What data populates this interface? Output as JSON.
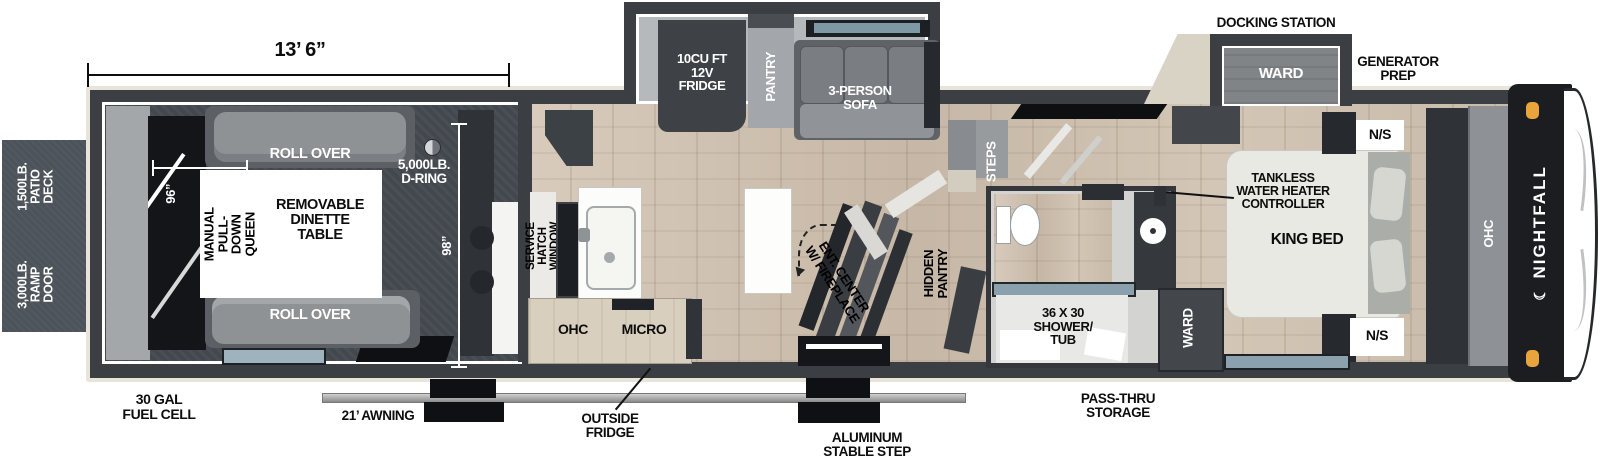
{
  "brand": {
    "name": "NIGHTFALL",
    "moon": "☾"
  },
  "dims": {
    "length": "13’ 6”",
    "garage_width": "96”",
    "garage_depth": "98”"
  },
  "exterior": {
    "patio_deck": "1,500LB.\nPATIO DECK",
    "ramp_door": "3,000LB.\nRAMP DOOR",
    "fuel_cell": "30 GAL\nFUEL CELL",
    "awning": "21’ AWNING",
    "outside_fridge": "OUTSIDE\nFRIDGE",
    "stable_step": "ALUMINUM\nSTABLE STEP",
    "pass_thru": "PASS-THRU\nSTORAGE",
    "docking_station": "DOCKING STATION",
    "generator_prep": "GENERATOR\nPREP"
  },
  "garage": {
    "roll_over": "ROLL OVER",
    "queen": "MANUAL\nPULL-DOWN\nQUEEN",
    "dinette": "REMOVABLE\nDINETTE\nTABLE",
    "d_ring": "5,000LB.\nD-RING"
  },
  "kitchen": {
    "service_hatch": "SERVICE HATCH\nWINDOW",
    "ohc": "OHC",
    "micro": "MICRO",
    "fridge": "10CU FT\n12V\nFRIDGE",
    "pantry": "PANTRY",
    "sofa": "3-PERSON\nSOFA",
    "ent_center": "ENT. CENTER\nW/ FIREPLACE",
    "hidden_pantry": "HIDDEN\nPANTRY",
    "steps": "STEPS"
  },
  "bath": {
    "shower": "36 X 30\nSHOWER/\nTUB",
    "ward": "WARD"
  },
  "bedroom": {
    "tankless": "TANKLESS\nWATER HEATER\nCONTROLLER",
    "king_bed": "KING BED",
    "ns": "N/S",
    "ohc": "OHC",
    "ward_slide": "WARD"
  },
  "colors": {
    "wall": "#3b3f43",
    "trim_beige": "#e9e4d9",
    "wood_floor": "#cfc2b2",
    "accent_orange": "#e9a43c",
    "window_glass": "#8aa2af"
  }
}
